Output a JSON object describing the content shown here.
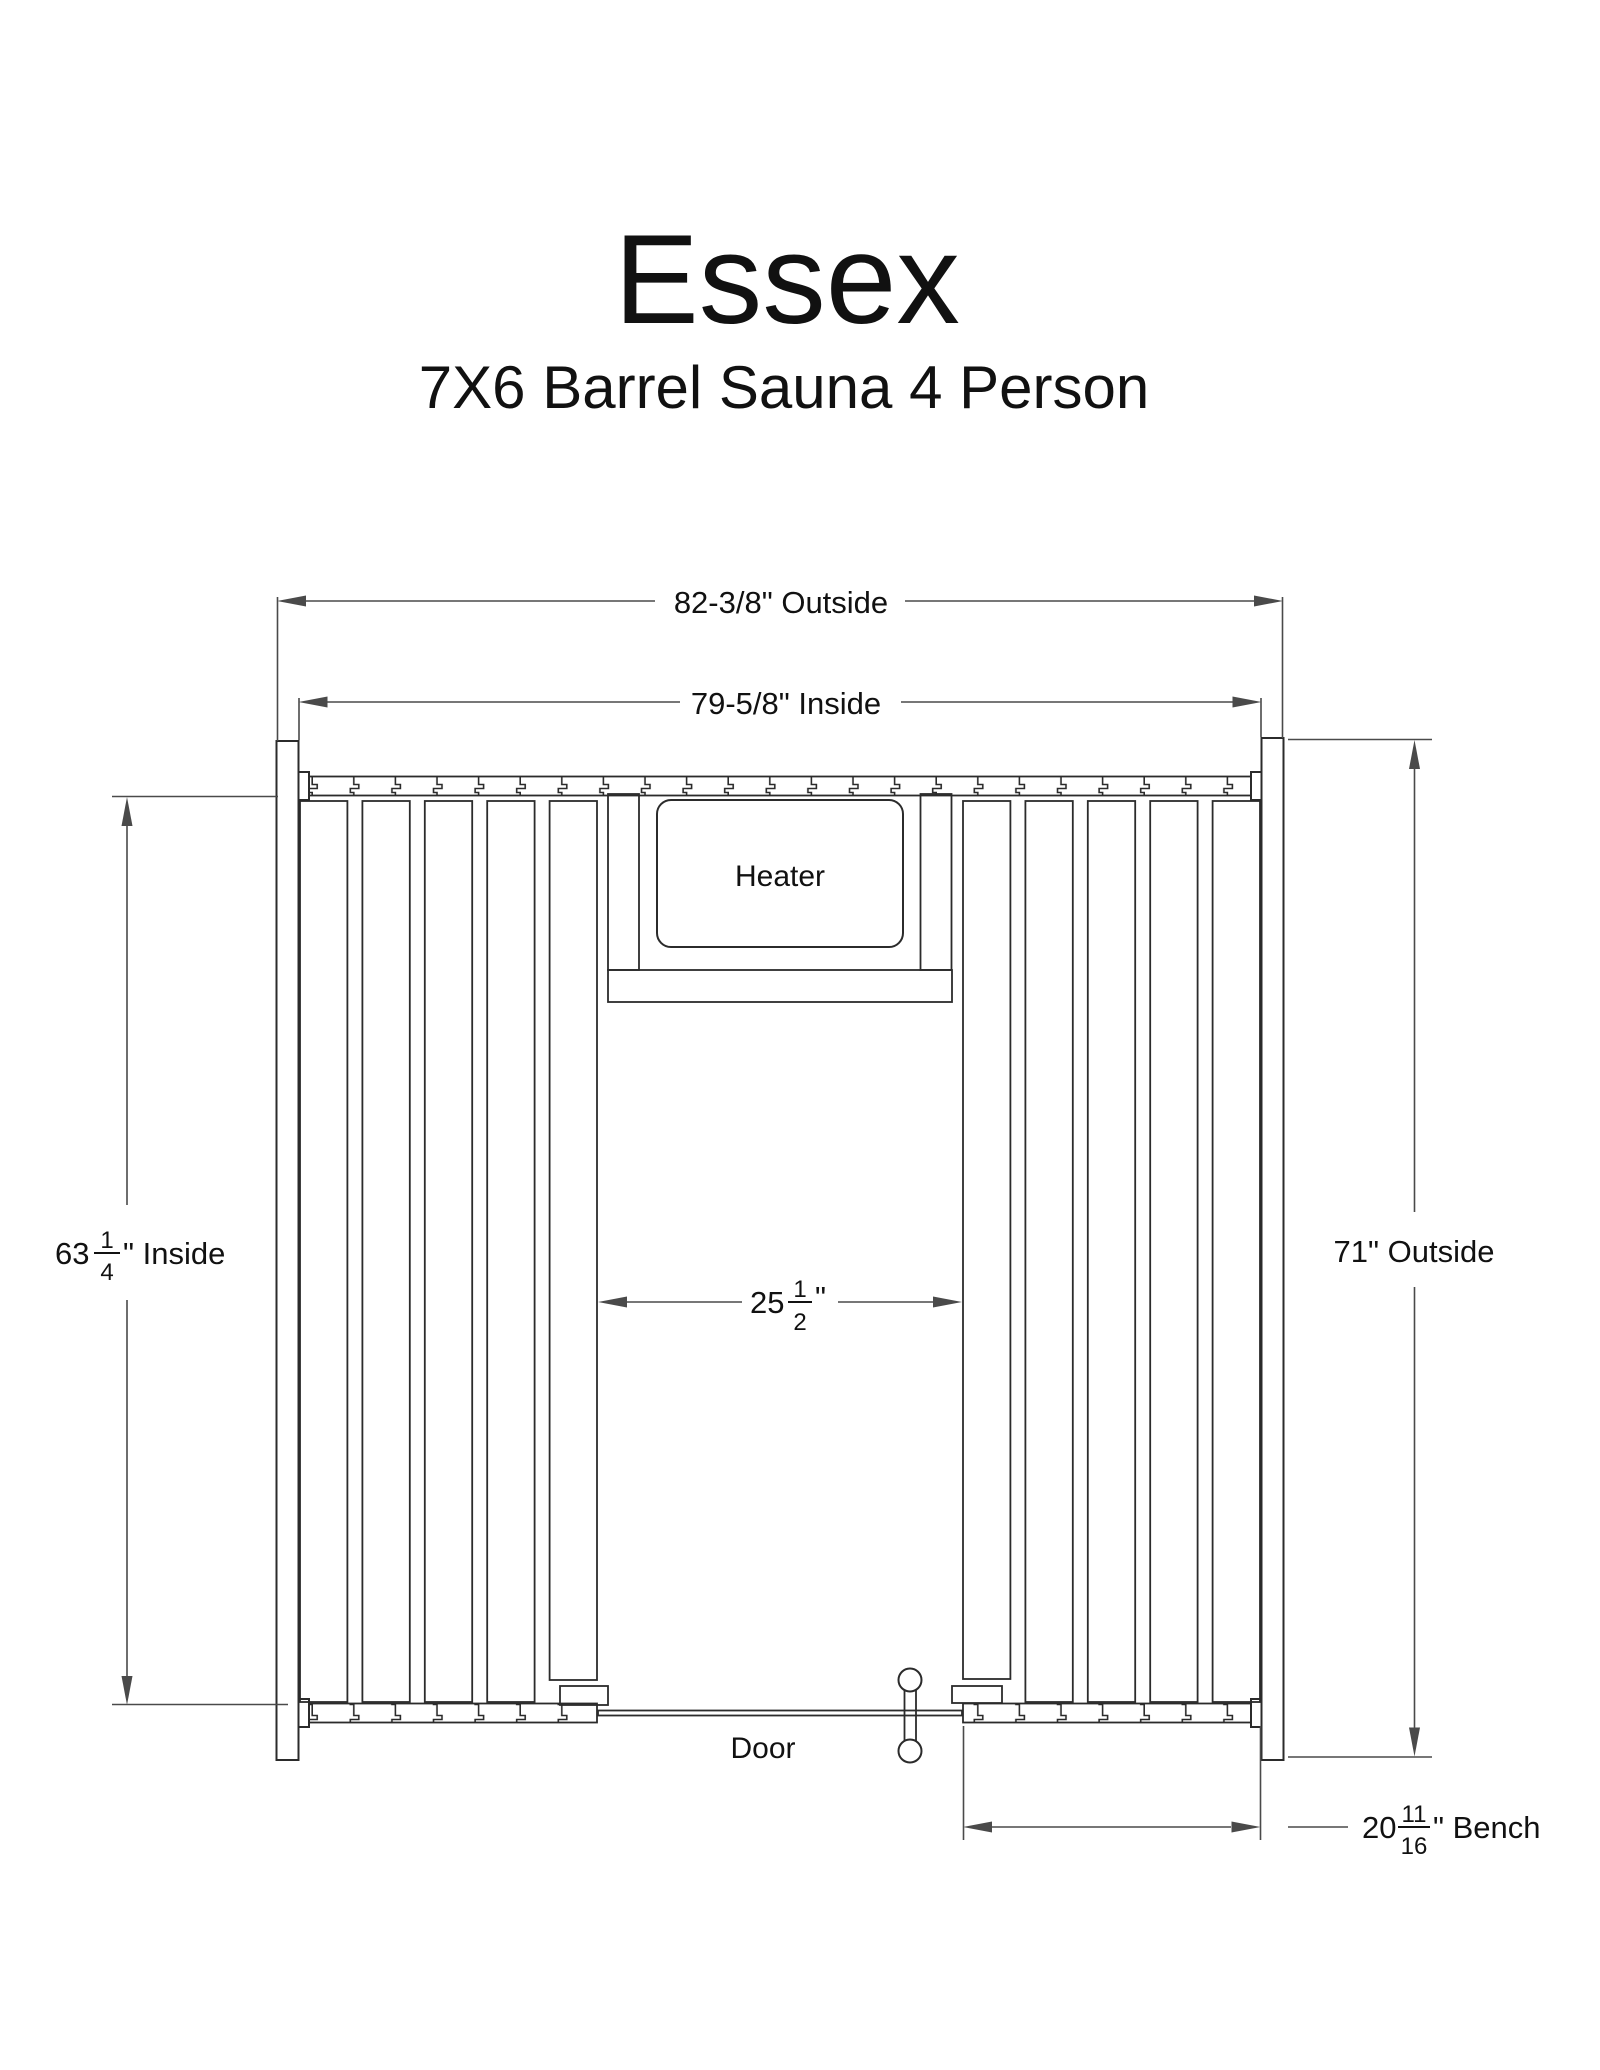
{
  "header": {
    "title": "Essex",
    "subtitle": "7X6 Barrel Sauna 4 Person"
  },
  "drawing": {
    "heater_label": "Heater",
    "door_label": "Door",
    "dimensions": {
      "outside_width": "82-3/8\" Outside",
      "inside_width": "79-5/8\" Inside",
      "outside_height": "71\" Outside",
      "inside_height": {
        "whole": "63",
        "numerator": "1",
        "denominator": "4",
        "suffix": "\" Inside"
      },
      "door_width": {
        "whole": "25",
        "numerator": "1",
        "denominator": "2",
        "suffix": "\""
      },
      "bench_depth": {
        "whole": "20",
        "numerator": "11",
        "denominator": "16",
        "suffix": "\" Bench"
      }
    },
    "colors": {
      "line": "#2b2b2b",
      "dim": "#4a4a4a",
      "text": "#111111",
      "background": "#ffffff"
    }
  }
}
